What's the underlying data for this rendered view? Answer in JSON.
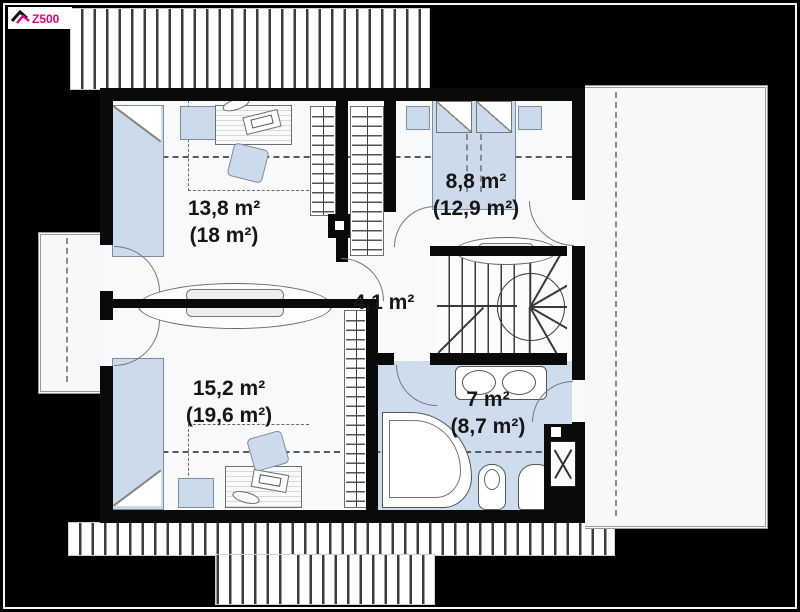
{
  "logo": {
    "brand": "Z500"
  },
  "plan": {
    "floor_name": "attic floor plan",
    "rooms": [
      {
        "id": "room-top-left",
        "area": "13,8 m²",
        "area_total": "(18 m²)"
      },
      {
        "id": "room-top-right",
        "area": "8,8 m²",
        "area_total": "(12,9 m²)"
      },
      {
        "id": "hall",
        "area": "4,1 m²",
        "area_total": ""
      },
      {
        "id": "room-bottom-left",
        "area": "15,2 m²",
        "area_total": "(19,6 m²)"
      },
      {
        "id": "bathroom",
        "area": "7 m²",
        "area_total": "(8,7 m²)"
      }
    ],
    "colors": {
      "wall": "#0a0a0a",
      "furniture_fill": "#ccdbec",
      "bathroom_floor": "#cedded",
      "logo_accent": "#e6007e",
      "roof_hatch_line": "#3c3c3c",
      "outdoor": "#f6f8fa",
      "background": "#000000"
    }
  }
}
